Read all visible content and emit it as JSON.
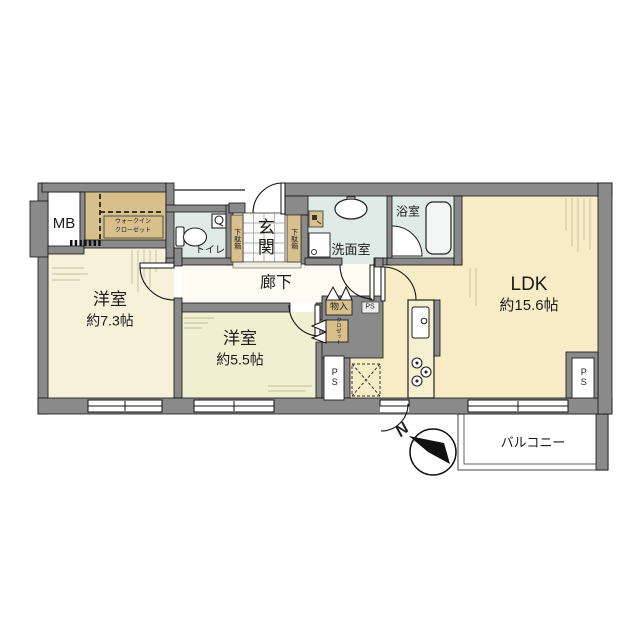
{
  "plan": {
    "title": "apartment-floor-plan",
    "rooms": {
      "ldk": {
        "label": "LDK",
        "size": "約15.6帖"
      },
      "western1": {
        "label": "洋室",
        "size": "約7.3帖"
      },
      "western2": {
        "label": "洋室",
        "size": "約5.5帖"
      },
      "corridor": {
        "label": "廊下"
      },
      "entrance": {
        "label": "玄関"
      },
      "washroom": {
        "label": "洗面室"
      },
      "bathroom": {
        "label": "浴室"
      },
      "toilet": {
        "label": "トイレ"
      },
      "walkin_closet": {
        "line1": "ウォークイン",
        "line2": "クローゼット"
      },
      "meter_box": {
        "label": "MB"
      },
      "storage": {
        "label": "物入"
      },
      "small_closet": {
        "label": "クロゼット"
      },
      "shoe_left": {
        "label": "下駄箱"
      },
      "shoe_right": {
        "label": "下駄箱"
      },
      "balcony": {
        "label": "バルコニー"
      }
    },
    "pipe_spaces": {
      "storage_side": "PS",
      "kitchen": "PS",
      "ldk_corner": "PS"
    },
    "compass": {
      "north": "N"
    },
    "colors": {
      "wall": "#8a8a8a",
      "room_cream": "#f8ecc6",
      "room_pale_green": "#eef0d2",
      "wet_area": "#e0ebe7",
      "closet_tan": "#d7c08c",
      "balcony_wall": "#666666"
    }
  }
}
